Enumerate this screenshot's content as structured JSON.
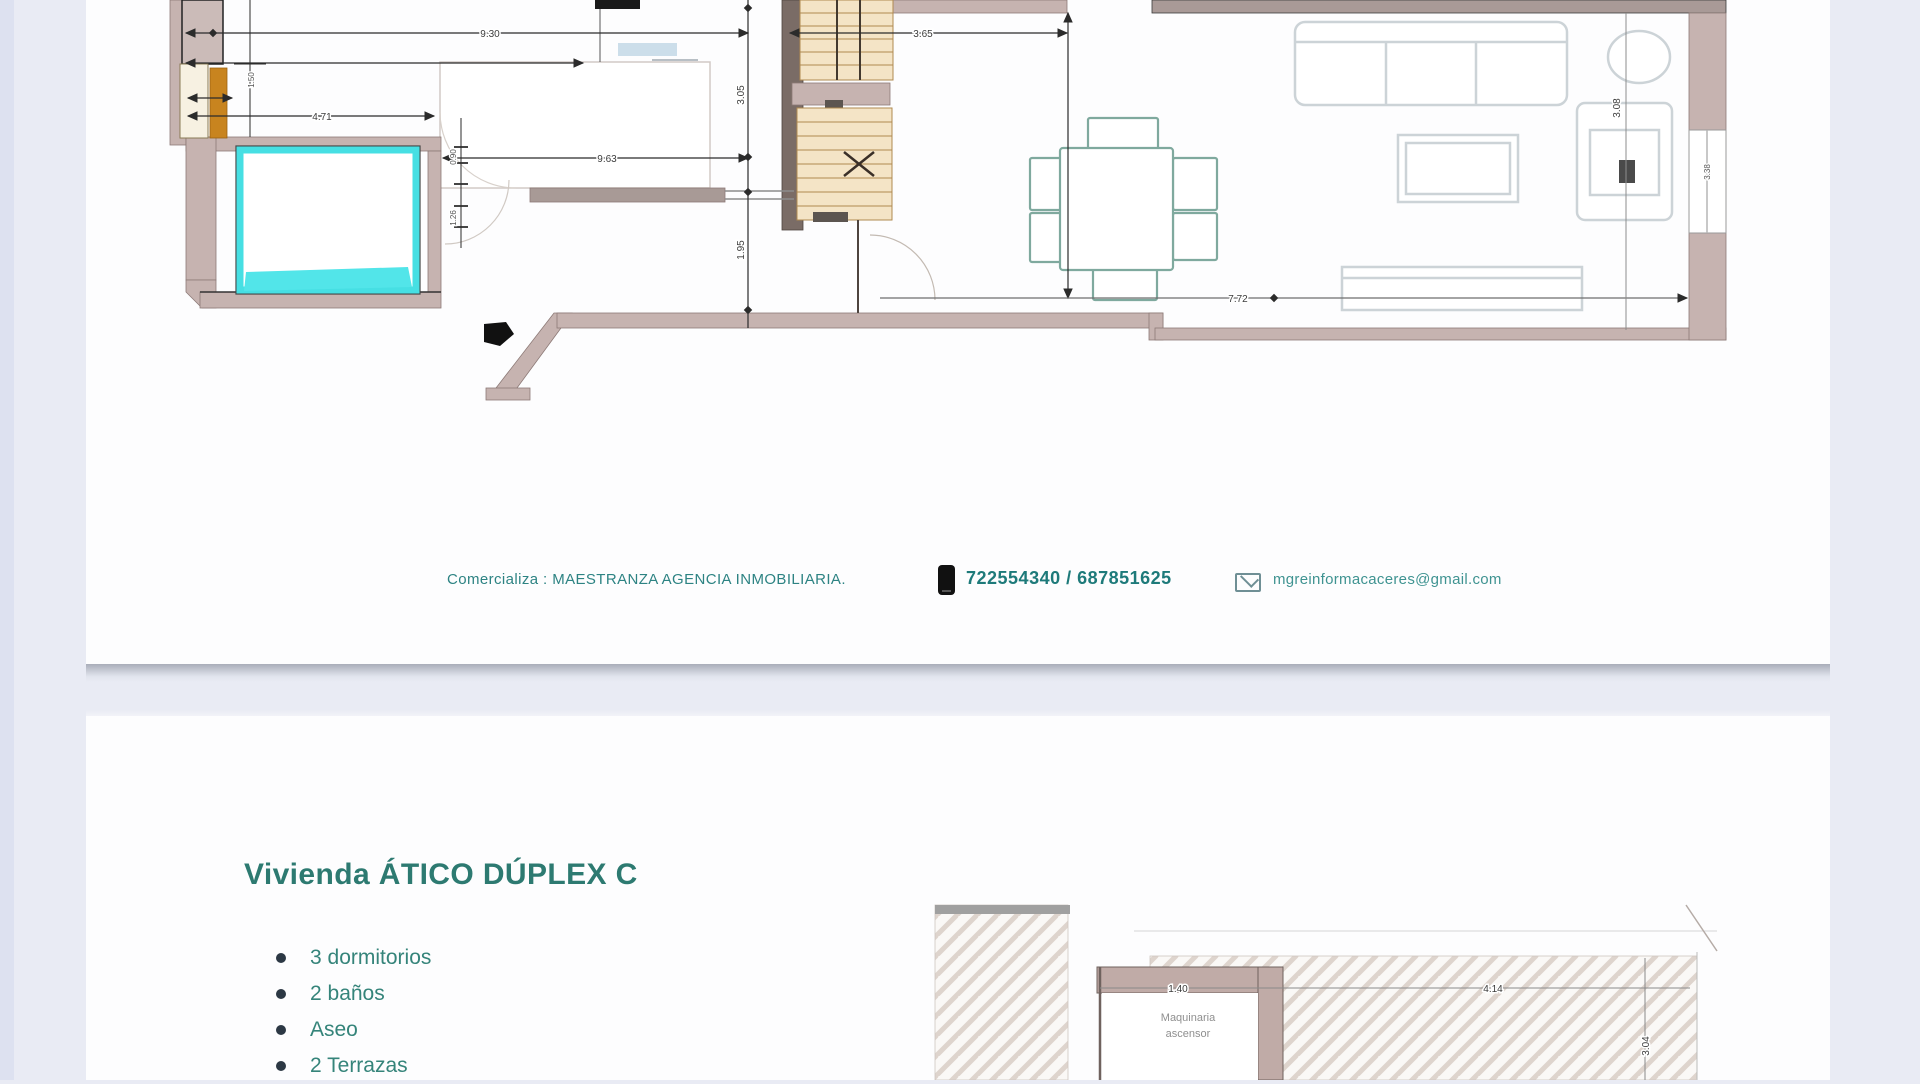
{
  "page1": {
    "contact": {
      "agency_line": "Comercializa : MAESTRANZA AGENCIA INMOBILIARIA.",
      "phones": "722554340 / 687851625",
      "email": "mgreinformacaceres@gmail.com"
    },
    "plan_dims": {
      "top_left_width": "9.30",
      "top_right_width": "3.65",
      "pool_width": "4.71",
      "hall_width": "9.63",
      "stair_height_a": "3.05",
      "stair_height_b": "1.95",
      "living_width": "7.72",
      "wall_seg": "1.50",
      "tick_a": "0.90",
      "tick_b": "1.26",
      "living_height": "3.08",
      "right_wall": "3.38"
    }
  },
  "page2": {
    "title": "Vivienda ÁTICO DÚPLEX C",
    "features": [
      "3 dormitorios",
      "2 baños",
      "Aseo",
      "2 Terrazas"
    ],
    "terrace_dims": {
      "machine_room_width": "1.40",
      "terrace_width": "4.14",
      "terrace_height": "3.04"
    },
    "machine_room_label_line1": "Maquinaria",
    "machine_room_label_line2": "ascensor"
  },
  "colors": {
    "accent_teal": "#2d7a71",
    "wall_mauve": "#c6b3b0",
    "pool_cyan": "#46dfe3",
    "stair_tan": "#f4e4c6",
    "furniture_gray": "#ccd3d7",
    "dining_teal": "#7fa99e",
    "background": "#e9ebf4"
  }
}
